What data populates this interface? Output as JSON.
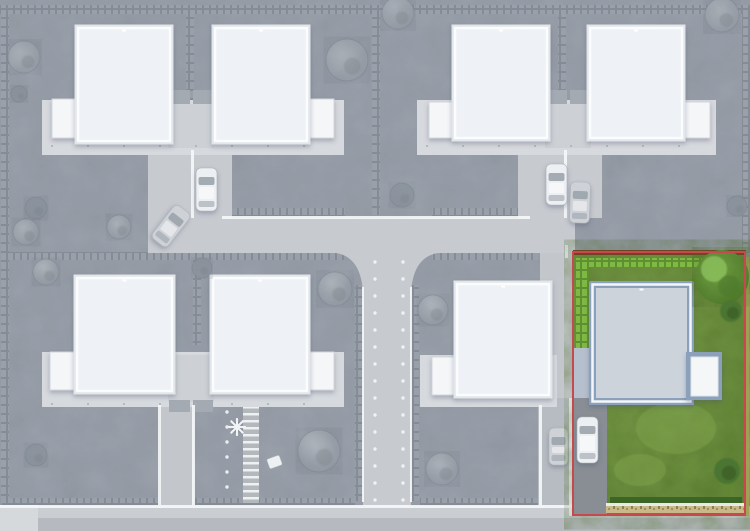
{
  "palette": {
    "garden": "#9ba2ac",
    "road": "#c7cacf",
    "court": "#c3c7cc",
    "courtDark": "#b7bcc2",
    "sidewalk": "#cacdd2",
    "street": "#b6bac0",
    "apron": "#d6d9dc",
    "terrace": "#d6d9dd",
    "connector": "#cdd1d5",
    "porch": "#a4aab2",
    "hedgeA": "#868c95",
    "hedgeB": "#9aa0a9",
    "white": "#f6f8f9",
    "ring": "#e2e6ea",
    "roof": "#eef1f5",
    "roofStroke": "#fbfcfd",
    "garage": "#f4f6f8",
    "garageStroke": "#d2d6db",
    "treeLight": "#aab0b8",
    "treeDark": "#8f96a0",
    "treeStroke": "rgba(118,126,137,0.4)",
    "carWhite": "#edf0f3",
    "carGray": "#ced2d7",
    "glass": "#9ba3ac",
    "wheel": "#767c84",
    "grassMid": "#6e9243",
    "grassHi": "#83a751",
    "grassLo": "#56772e",
    "hedgeGreenA": "#5e8f30",
    "hedgeGreenB": "#7fb944",
    "treeGreen": "#5f913a",
    "treeGreenHi": "#8fc45e",
    "treeGreenLo": "#4e7a2e",
    "bushGreen": "#4c7530",
    "bushGreenCore": "#3d5f25",
    "oliveEdge": "#a3a150",
    "fenceBrown": "#6e4424",
    "gravel": "#c9b989",
    "gravelTick": "#8a7f55",
    "highlightRed": "#c8494d",
    "blueGray": "#8ba0ba",
    "paveBlue": "#b5bfce",
    "roofSelected": "#cdd3db",
    "driveDark": "#888e94",
    "stepsBase": "#b3b8bd",
    "dotWhite": "#f4f6f8",
    "postDot": "#a9afb6"
  },
  "scene": {
    "hedges": [
      [
        0,
        5,
        750,
        9
      ],
      [
        1,
        5,
        8,
        498
      ],
      [
        742,
        5,
        8,
        248
      ],
      [
        186,
        5,
        8,
        96
      ],
      [
        372,
        5,
        8,
        210
      ],
      [
        558,
        5,
        8,
        91
      ],
      [
        232,
        208,
        113,
        8
      ],
      [
        432,
        208,
        88,
        8
      ],
      [
        2,
        252,
        342,
        8
      ],
      [
        432,
        252,
        106,
        8
      ],
      [
        355,
        285,
        8,
        216
      ],
      [
        411,
        285,
        8,
        216
      ],
      [
        2,
        498,
        157,
        8
      ],
      [
        195,
        498,
        160,
        8
      ],
      [
        420,
        498,
        118,
        8
      ],
      [
        193,
        255,
        8,
        90
      ]
    ],
    "roads": [
      {
        "x": 148,
        "y": 218,
        "w": 427,
        "h": 35,
        "c": "road",
        "n": "main-road"
      },
      {
        "x": 148,
        "y": 148,
        "w": 84,
        "h": 70,
        "c": "road",
        "n": "courtyard-top-left"
      },
      {
        "x": 518,
        "y": 148,
        "w": 84,
        "h": 70,
        "c": "road",
        "n": "courtyard-top-right"
      },
      {
        "x": 363,
        "y": 253,
        "w": 48,
        "h": 260,
        "c": "road",
        "n": "center-road"
      },
      {
        "x": 160,
        "y": 405,
        "w": 34,
        "h": 101,
        "c": "court",
        "n": "driveway-bottom-left"
      },
      {
        "x": 540,
        "y": 253,
        "w": 33,
        "h": 150,
        "c": "court",
        "n": "side-path"
      },
      {
        "x": 538,
        "y": 398,
        "w": 35,
        "h": 108,
        "c": "courtDark",
        "n": "courtyard-bottom-right"
      },
      {
        "x": 0,
        "y": 506,
        "w": 750,
        "h": 12,
        "c": "sidewalk",
        "n": "bottom-sidewalk"
      },
      {
        "x": 0,
        "y": 518,
        "w": 750,
        "h": 13,
        "c": "street",
        "n": "bottom-street"
      },
      {
        "x": 0,
        "y": 505,
        "w": 38,
        "h": 26,
        "c": "apron",
        "n": "driveway-apron"
      },
      {
        "x": 243,
        "y": 407,
        "w": 16,
        "h": 96,
        "c": "steps",
        "n": "stepping-stone-path"
      }
    ],
    "flares": [
      "M336,253 Q361,257 363,293 L363,253 Z",
      "M438,253 Q413,257 411,293 L411,253 Z"
    ],
    "connectors": [
      [
        168,
        104,
        46,
        44
      ],
      [
        545,
        104,
        46,
        44
      ],
      [
        168,
        355,
        46,
        47
      ]
    ],
    "porches": [
      [
        169,
        90,
        21,
        14
      ],
      [
        193,
        90,
        20,
        14
      ],
      [
        546,
        90,
        21,
        14
      ],
      [
        570,
        90,
        20,
        14
      ],
      [
        169,
        400,
        21,
        12
      ],
      [
        193,
        400,
        20,
        12
      ]
    ],
    "terraces": [
      [
        42,
        100,
        302,
        55
      ],
      [
        417,
        100,
        299,
        55
      ],
      [
        42,
        352,
        302,
        55
      ],
      [
        420,
        355,
        137,
        52
      ]
    ],
    "white_lines": [
      [
        222,
        216,
        308,
        3
      ],
      [
        191,
        150,
        3,
        68
      ],
      [
        564,
        150,
        3,
        68
      ],
      [
        158,
        405,
        3,
        100
      ],
      [
        192,
        405,
        3,
        100
      ],
      [
        539,
        405,
        3,
        100
      ],
      [
        0,
        505,
        574,
        3
      ],
      [
        565,
        245,
        3,
        13
      ],
      [
        569,
        398,
        3,
        118
      ],
      [
        362,
        287,
        2,
        215
      ],
      [
        410,
        287,
        2,
        215
      ]
    ],
    "garages": [
      [
        52,
        99,
        26,
        39
      ],
      [
        308,
        99,
        26,
        39
      ],
      [
        429,
        102,
        26,
        36
      ],
      [
        684,
        102,
        26,
        36
      ],
      [
        50,
        352,
        26,
        38
      ],
      [
        308,
        352,
        26,
        38
      ],
      [
        432,
        357,
        25,
        38
      ]
    ],
    "houses": [
      [
        78,
        28,
        92,
        113
      ],
      [
        215,
        28,
        92,
        113
      ],
      [
        455,
        28,
        92,
        110
      ],
      [
        590,
        28,
        92,
        110
      ],
      [
        77,
        278,
        95,
        113
      ],
      [
        213,
        278,
        94,
        113
      ],
      [
        457,
        284,
        92,
        111
      ]
    ],
    "trees": [
      [
        24,
        57,
        16,
        0
      ],
      [
        19,
        94,
        8,
        1
      ],
      [
        36,
        208,
        11,
        1
      ],
      [
        26,
        232,
        13,
        0
      ],
      [
        347,
        60,
        21,
        0
      ],
      [
        119,
        227,
        12,
        0
      ],
      [
        398,
        13,
        16,
        0
      ],
      [
        722,
        15,
        17,
        0
      ],
      [
        402,
        195,
        12,
        1
      ],
      [
        737,
        206,
        10,
        1
      ],
      [
        433,
        310,
        15,
        0
      ],
      [
        442,
        469,
        16,
        0
      ],
      [
        335,
        289,
        17,
        0
      ],
      [
        46,
        272,
        13,
        0
      ],
      [
        202,
        268,
        10,
        1
      ],
      [
        36,
        455,
        11,
        1
      ],
      [
        319,
        451,
        21,
        0
      ]
    ],
    "cars": [
      [
        196,
        168,
        21,
        43,
        0,
        "w"
      ],
      [
        161,
        205,
        20,
        42,
        38,
        "g"
      ],
      [
        546,
        164,
        21,
        41,
        0,
        "w"
      ],
      [
        570,
        182,
        20,
        41,
        2,
        "g"
      ],
      [
        549,
        428,
        19,
        37,
        0,
        "g"
      ]
    ],
    "light_rows": [
      {
        "x": 375,
        "y0": 262,
        "y1": 500,
        "st": 17
      },
      {
        "x": 403,
        "y0": 262,
        "y1": 500,
        "st": 17
      },
      {
        "x": 227,
        "y0": 412,
        "y1": 498,
        "st": 15
      }
    ],
    "post_rows": [
      {
        "y": 146,
        "x0": 52,
        "x1": 336,
        "st": 36
      },
      {
        "y": 146,
        "x0": 427,
        "x1": 710,
        "st": 36
      },
      {
        "y": 404,
        "x0": 52,
        "x1": 336,
        "st": 36
      }
    ],
    "palm": {
      "x": 237,
      "y": 427
    },
    "bench": {
      "x": 268,
      "y": 457,
      "w": 13,
      "h": 10,
      "rot": -20
    }
  },
  "highlight_plot": {
    "selected": true,
    "bounds": [
      573,
      253,
      173,
      263
    ],
    "fence": [
      573,
      250,
      173,
      5
    ],
    "hedge_top": [
      576,
      258,
      126,
      9
    ],
    "hedge_left": [
      576,
      258,
      13,
      94
    ],
    "edge_right": [
      744,
      257,
      5,
      259
    ],
    "paving": [
      574,
      348,
      32,
      50
    ],
    "driveway": [
      574,
      398,
      33,
      116
    ],
    "terrace": [
      589,
      393,
      105,
      12
    ],
    "house": {
      "surround": [
        589,
        281,
        105,
        124
      ],
      "roof": [
        596,
        288,
        91,
        110
      ],
      "garage_surround": [
        686,
        352,
        36,
        48
      ],
      "garage": [
        691,
        357,
        27,
        39
      ]
    },
    "patches": [
      [
        620,
        318,
        30,
        20,
        "light"
      ],
      [
        676,
        428,
        40,
        26,
        "light"
      ],
      [
        658,
        378,
        32,
        22,
        "dark"
      ],
      [
        608,
        300,
        18,
        13,
        "dark"
      ],
      [
        640,
        470,
        26,
        16,
        "light"
      ]
    ],
    "hedge_bottom": [
      610,
      497,
      132,
      8
    ],
    "gravel": [
      606,
      506,
      139,
      7
    ],
    "white_line": [
      606,
      503,
      139,
      3
    ],
    "tree": {
      "x": 722,
      "y": 277,
      "r": 27
    },
    "bushes": [
      [
        731,
        311,
        11
      ],
      [
        727,
        471,
        13
      ]
    ],
    "car": [
      577,
      417,
      21,
      46
    ],
    "border": [
      573,
      252,
      172,
      263
    ],
    "border_color": "#c8494d"
  }
}
